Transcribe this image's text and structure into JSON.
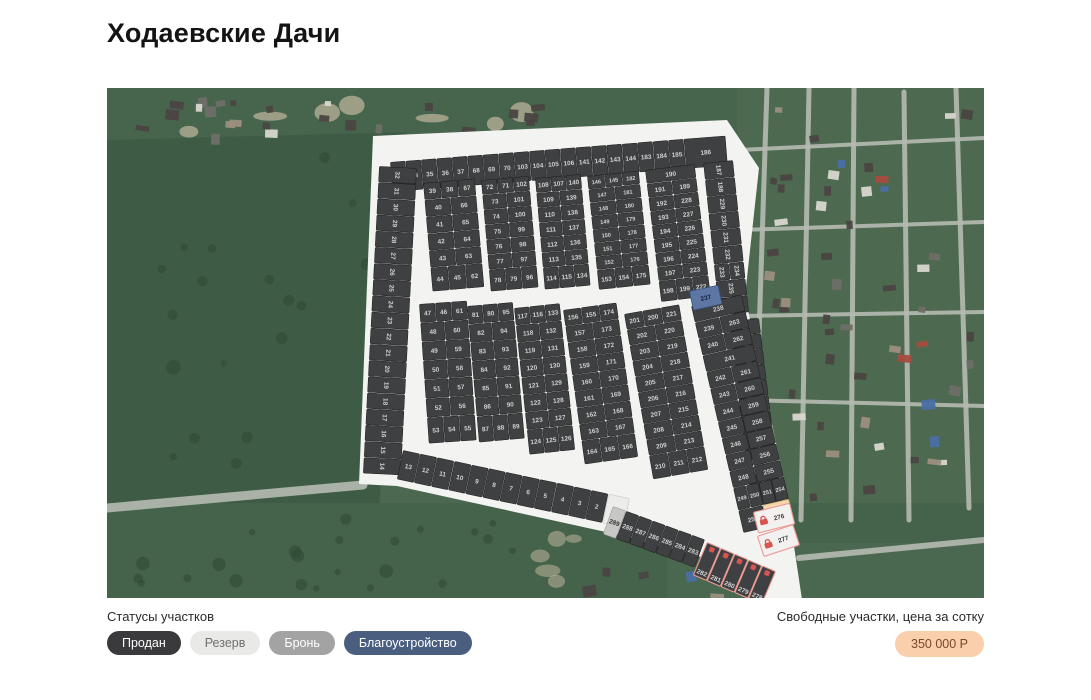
{
  "page": {
    "title": "Ходаевские Дачи"
  },
  "legend": {
    "label": "Статусы участков",
    "items": [
      {
        "key": "sold",
        "label": "Продан"
      },
      {
        "key": "reserve",
        "label": "Резерв"
      },
      {
        "key": "booked",
        "label": "Бронь"
      },
      {
        "key": "improvement",
        "label": "Благоустройство"
      }
    ]
  },
  "price": {
    "label": "Свободные участки, цена за сотку",
    "value": "350 000 Р"
  },
  "colors": {
    "legend": {
      "sold": {
        "bg": "#3a3a3c",
        "text": "#ffffff"
      },
      "reserve": {
        "bg": "#e9e9e7",
        "text": "#6f6f6f"
      },
      "booked": {
        "bg": "#a3a3a3",
        "text": "#ffffff"
      },
      "improvement": {
        "bg": "#4a5f80",
        "text": "#ffffff"
      }
    },
    "price": {
      "bg": "#f9d0ab",
      "text": "#77492e"
    },
    "lock": "#d9534f",
    "road": "#f3f3f1",
    "status": {
      "sold": {
        "bg": "#3f4042",
        "stroke": "#1c1c1c",
        "sw": 0.5,
        "text": "#d0d0d0"
      },
      "reserve": {
        "bg": "#c7c7c5",
        "stroke": "#8f8f8d",
        "sw": 0.5,
        "text": "#333333"
      },
      "free": {
        "bg": "#f5d7ab",
        "stroke": "#d7ae79",
        "sw": 0.8,
        "text": "#6b4c26"
      },
      "improvement": {
        "bg": "#5d76a4",
        "stroke": "#37517e",
        "sw": 0.8,
        "text": "#16233d"
      },
      "booked-light": {
        "bg": "#f2f1ef",
        "stroke": "#ec9b95",
        "sw": 1.1,
        "text": "#3a3a3a"
      },
      "booked-dark": {
        "bg": "#3f4042",
        "stroke": "#ec9b95",
        "sw": 1.1,
        "text": "#d5d5d5"
      },
      "white": {
        "bg": "#ececea",
        "stroke": "#bfbfbd",
        "sw": 0.5,
        "text": "#3a3a3a"
      }
    }
  },
  "map": {
    "footprint": [
      [
        266,
        48
      ],
      [
        620,
        32
      ],
      [
        652,
        80
      ],
      [
        638,
        208
      ],
      [
        678,
        398
      ],
      [
        700,
        545
      ],
      [
        598,
        470
      ],
      [
        508,
        446
      ],
      [
        290,
        398
      ],
      [
        252,
        396
      ]
    ],
    "strips": [
      {
        "name": "top-row",
        "x": 283,
        "y": 74,
        "angle": -4.5,
        "step": 15.5,
        "depth": 30,
        "plots": [
          33,
          34,
          35,
          36,
          37,
          68,
          69,
          70,
          103,
          104,
          105,
          106,
          141,
          142,
          143,
          144,
          183,
          184,
          185,
          {
            "n": 186,
            "w": 42
          }
        ]
      },
      {
        "name": "left-col",
        "x": 310,
        "y": 80,
        "angle": 93,
        "step": 16.2,
        "depth": 38,
        "plots": [
          32,
          31,
          30,
          29,
          28,
          27,
          26,
          25,
          24,
          23,
          22,
          21,
          20,
          19,
          18,
          17,
          16,
          15,
          14
        ]
      },
      {
        "name": "right-col-upper",
        "x": 626,
        "y": 72,
        "angle": 84,
        "step": 17,
        "depth": 30,
        "plots": [
          187,
          188,
          229,
          230,
          231,
          232,
          [
            234,
            233
          ],
          235,
          236
        ]
      },
      {
        "name": "right-col-lower",
        "x": 652,
        "y": 230,
        "angle": 83,
        "step": 15.5,
        "depth": 30,
        "plots": [
          264,
          265,
          266,
          267,
          268,
          269,
          270,
          271,
          272,
          273,
          274,
          275
        ]
      },
      {
        "name": "bottom-row",
        "x": 296,
        "y": 362,
        "angle": 12,
        "step": 17.5,
        "depth": 30,
        "plots": [
          13,
          12,
          11,
          10,
          9,
          8,
          7,
          6,
          5,
          4,
          3,
          2,
          {
            "n": 1,
            "w": 22
          }
        ]
      },
      {
        "name": "bottom-road-row",
        "x": 506,
        "y": 418,
        "angle": 20,
        "step": 14,
        "depth": 30,
        "plots": [
          289,
          288,
          287,
          286,
          285,
          284,
          283
        ]
      },
      {
        "name": "bottom-edge-row",
        "x": 600,
        "y": 454,
        "angle": 23,
        "step": 15,
        "depth": 36,
        "plots": [
          282,
          281,
          280,
          279,
          278
        ]
      }
    ],
    "blocks": [
      {
        "name": "U1",
        "x": 316,
        "y": 95,
        "angle": -5,
        "w1": 26,
        "w2": 26,
        "rowH": 17,
        "tallH": 24,
        "rows": [
          [
            39,
            38,
            67
          ],
          [
            40,
            66
          ],
          [
            41,
            65
          ],
          [
            42,
            64
          ],
          [
            43,
            63
          ],
          [
            44,
            45,
            62
          ]
        ]
      },
      {
        "name": "U2",
        "x": 374,
        "y": 92,
        "angle": -5,
        "w1": 24,
        "w2": 24,
        "rowH": 15,
        "tallH": 22,
        "rows": [
          [
            72,
            71,
            102
          ],
          [
            73,
            101
          ],
          [
            74,
            100
          ],
          [
            75,
            99
          ],
          [
            76,
            98
          ],
          [
            77,
            97
          ],
          [
            78,
            79,
            96
          ]
        ]
      },
      {
        "name": "U3",
        "x": 428,
        "y": 90,
        "angle": -5,
        "w1": 23,
        "w2": 23,
        "rowH": 15,
        "tallH": 22,
        "rows": [
          [
            108,
            107,
            140
          ],
          [
            109,
            139
          ],
          [
            110,
            138
          ],
          [
            111,
            137
          ],
          [
            112,
            136
          ],
          [
            113,
            135
          ],
          [
            114,
            115,
            134
          ]
        ]
      },
      {
        "name": "U4",
        "x": 480,
        "y": 88,
        "angle": -6,
        "w1": 26,
        "w2": 26,
        "rowH": 13.5,
        "tallH": 20,
        "rows": [
          [
            146,
            145,
            182
          ],
          [
            147,
            181
          ],
          [
            148,
            180
          ],
          [
            149,
            179
          ],
          [
            150,
            178
          ],
          [
            151,
            177
          ],
          [
            152,
            176
          ],
          [
            153,
            154,
            175
          ]
        ]
      },
      {
        "name": "U5",
        "x": 538,
        "y": 82,
        "angle": -7,
        "w1": 25,
        "w2": 25,
        "rowH": 14,
        "tallH": 21,
        "rows": [
          [
            190
          ],
          [
            191,
            189
          ],
          [
            192,
            228
          ],
          [
            193,
            227
          ],
          [
            194,
            226
          ],
          [
            195,
            225
          ],
          [
            196,
            224
          ],
          [
            197,
            223
          ],
          [
            198,
            199,
            222
          ]
        ]
      },
      {
        "name": "L1",
        "x": 312,
        "y": 216,
        "angle": -4,
        "w1": 24,
        "w2": 24,
        "rowH": 19,
        "tallH": 26,
        "rows": [
          [
            47,
            46,
            61
          ],
          [
            48,
            60
          ],
          [
            49,
            59
          ],
          [
            50,
            58
          ],
          [
            51,
            57
          ],
          [
            52,
            56
          ],
          [
            53,
            54,
            55
          ]
        ]
      },
      {
        "name": "L2",
        "x": 360,
        "y": 218,
        "angle": -5,
        "w1": 23,
        "w2": 23,
        "rowH": 18.5,
        "tallH": 26,
        "rows": [
          [
            81,
            80,
            95
          ],
          [
            82,
            94
          ],
          [
            83,
            93
          ],
          [
            84,
            92
          ],
          [
            85,
            91
          ],
          [
            86,
            90
          ],
          [
            87,
            88,
            89
          ]
        ]
      },
      {
        "name": "L3",
        "x": 407,
        "y": 220,
        "angle": -6,
        "w1": 23,
        "w2": 23,
        "rowH": 17.5,
        "tallH": 25,
        "rows": [
          [
            117,
            116,
            133
          ],
          [
            118,
            132
          ],
          [
            119,
            131
          ],
          [
            120,
            130
          ],
          [
            121,
            129
          ],
          [
            122,
            128
          ],
          [
            123,
            127
          ],
          [
            124,
            125,
            126
          ]
        ]
      },
      {
        "name": "L4",
        "x": 456,
        "y": 222,
        "angle": -8,
        "w1": 27,
        "w2": 27,
        "rowH": 16.5,
        "tallH": 24,
        "rows": [
          [
            156,
            155,
            174
          ],
          [
            157,
            173
          ],
          [
            158,
            172
          ],
          [
            159,
            171
          ],
          [
            160,
            170
          ],
          [
            161,
            169
          ],
          [
            162,
            168
          ],
          [
            163,
            167
          ],
          [
            164,
            165,
            166
          ]
        ]
      },
      {
        "name": "L5",
        "x": 517,
        "y": 226,
        "angle": -10,
        "w1": 28,
        "w2": 28,
        "rowH": 16,
        "tallH": 24,
        "rows": [
          [
            201,
            200,
            221
          ],
          [
            202,
            220
          ],
          [
            203,
            219
          ],
          [
            204,
            218
          ],
          [
            205,
            217
          ],
          [
            206,
            216
          ],
          [
            207,
            215
          ],
          [
            208,
            214
          ],
          [
            209,
            213
          ],
          [
            210,
            211,
            212
          ]
        ]
      },
      {
        "name": "F",
        "x": 584,
        "y": 218,
        "angle": -13,
        "w1": 25,
        "w2": 27,
        "rowH": 17,
        "tallH": 23,
        "rows": [
          [
            238
          ],
          [
            239,
            263
          ],
          [
            240,
            262
          ],
          [
            241
          ],
          [
            242,
            261
          ],
          [
            243,
            260
          ],
          [
            244,
            259
          ],
          [
            245,
            258
          ],
          [
            246,
            257
          ],
          [
            247,
            256
          ],
          [
            248,
            255
          ],
          [
            249,
            250,
            251,
            254
          ],
          [
            252,
            253
          ]
        ]
      }
    ],
    "singles": [
      {
        "n": 237,
        "x": 582,
        "y": 203,
        "w": 30,
        "h": 20,
        "angle": -12
      },
      {
        "n": 276,
        "x": 646,
        "y": 424,
        "w": 38,
        "h": 22,
        "angle": -14
      },
      {
        "n": 277,
        "x": 650,
        "y": 448,
        "w": 38,
        "h": 22,
        "angle": -18
      }
    ],
    "statusOverrides": {
      "1": "white",
      "237": "improvement",
      "253": "free",
      "273": "reserve",
      "289": "reserve",
      "276": "booked-light",
      "277": "booked-light",
      "278": "booked-dark",
      "279": "booked-dark",
      "280": "booked-dark",
      "281": "booked-dark",
      "282": "booked-dark"
    }
  }
}
